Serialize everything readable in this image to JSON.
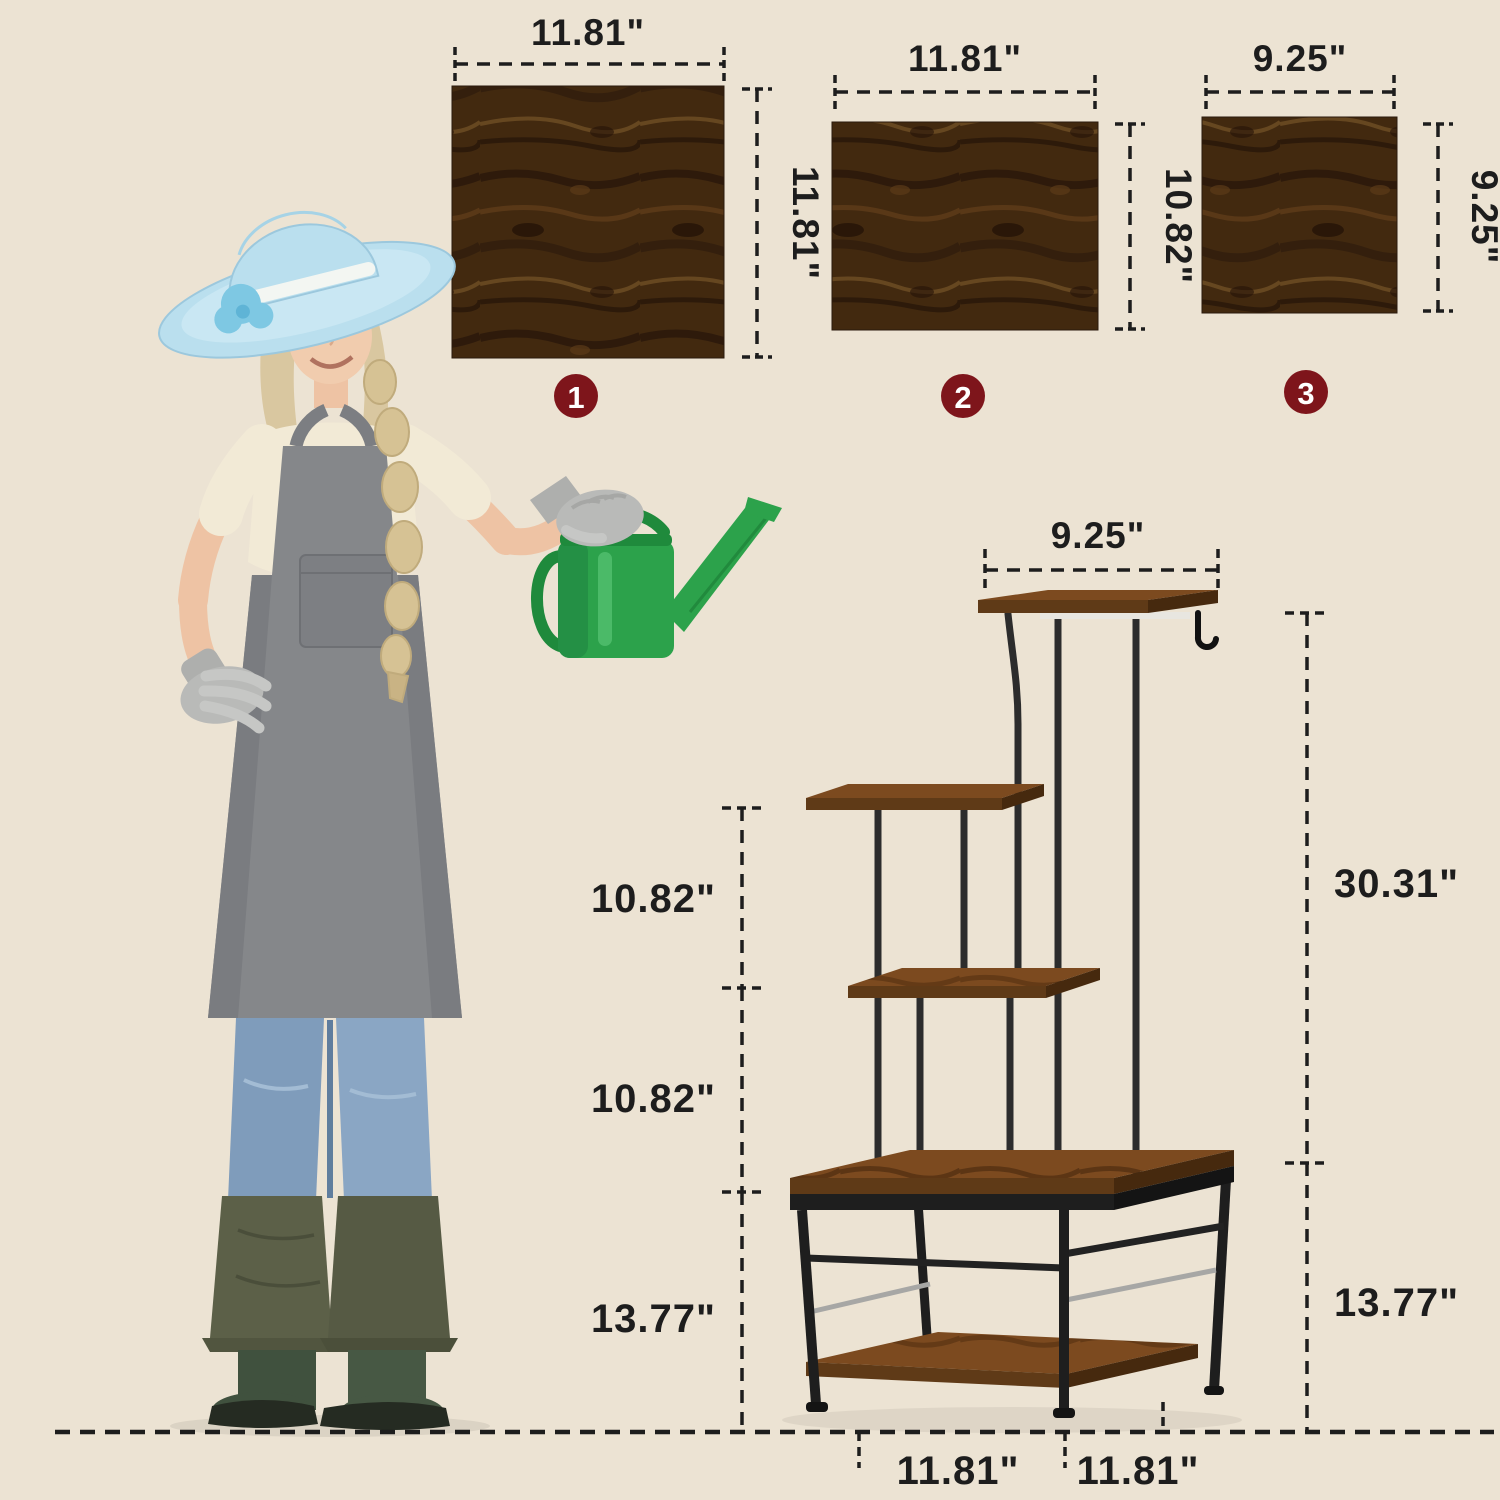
{
  "scene": {
    "background_color": "#ECE3D3",
    "description_texts": []
  },
  "panels": [
    {
      "badge": "1",
      "width_label": "11.81\"",
      "height_label": "11.81\""
    },
    {
      "badge": "2",
      "width_label": "11.81\"",
      "height_label": "10.82\""
    },
    {
      "badge": "3",
      "width_label": "9.25\"",
      "height_label": "9.25\""
    }
  ],
  "stand": {
    "top_width_label": "9.25\"",
    "upper_height_label": "30.31\"",
    "gap_top_label": "10.82\"",
    "gap_middle_label": "10.82\"",
    "base_height_left_label": "13.77\"",
    "base_height_right_label": "13.77\"",
    "base_depth_label": "11.81\"",
    "base_width_label": "11.81\""
  },
  "icons": [
    {
      "name": "hanging-hook-icon"
    },
    {
      "name": "watering-can"
    },
    {
      "name": "panel-number-badge",
      "shape": "circle"
    }
  ],
  "colors": {
    "badge_red": "#7E151B",
    "wood_dark": "#42290F",
    "wood_mid": "#7C4A1F",
    "metal_black": "#232323",
    "dimension_ink": "#1D1D1D",
    "watering_can_green": "#2CA24B",
    "hat_blue": "#BADFEE",
    "apron_gray": "#85878A",
    "boots_green": "#40513E",
    "jeans_blue": "#7F9CBB"
  }
}
